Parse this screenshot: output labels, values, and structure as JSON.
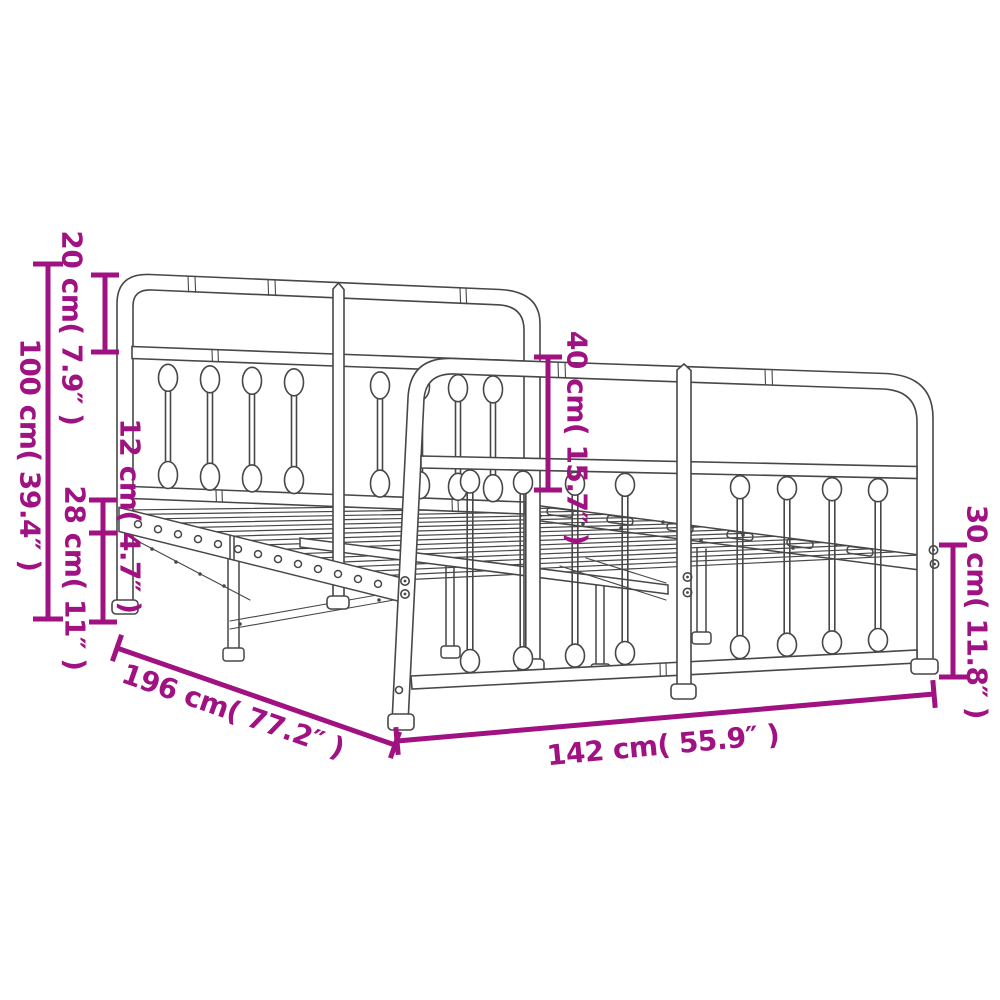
{
  "diagram": {
    "title": "metal bed frame dimension drawing",
    "colors": {
      "dimension": "#A01182",
      "line_art": "#474747",
      "background": "#ffffff"
    },
    "dimensions": [
      {
        "id": "headboard-top-section-height",
        "text": "20 cm( 7.9″ )"
      },
      {
        "id": "headboard-total-height",
        "text": "100 cm( 39.4″ )"
      },
      {
        "id": "side-rail-depth",
        "text": "12 cm( 4.7″ )"
      },
      {
        "id": "under-bed-clearance",
        "text": "28 cm( 11″ )"
      },
      {
        "id": "footboard-upper-height",
        "text": "40 cm( 15.7″ )"
      },
      {
        "id": "footboard-lower-height",
        "text": "30 cm( 11.8″ )"
      },
      {
        "id": "frame-length",
        "text": "196 cm( 77.2″ )"
      },
      {
        "id": "frame-width",
        "text": "142 cm( 55.9″ )"
      }
    ]
  }
}
